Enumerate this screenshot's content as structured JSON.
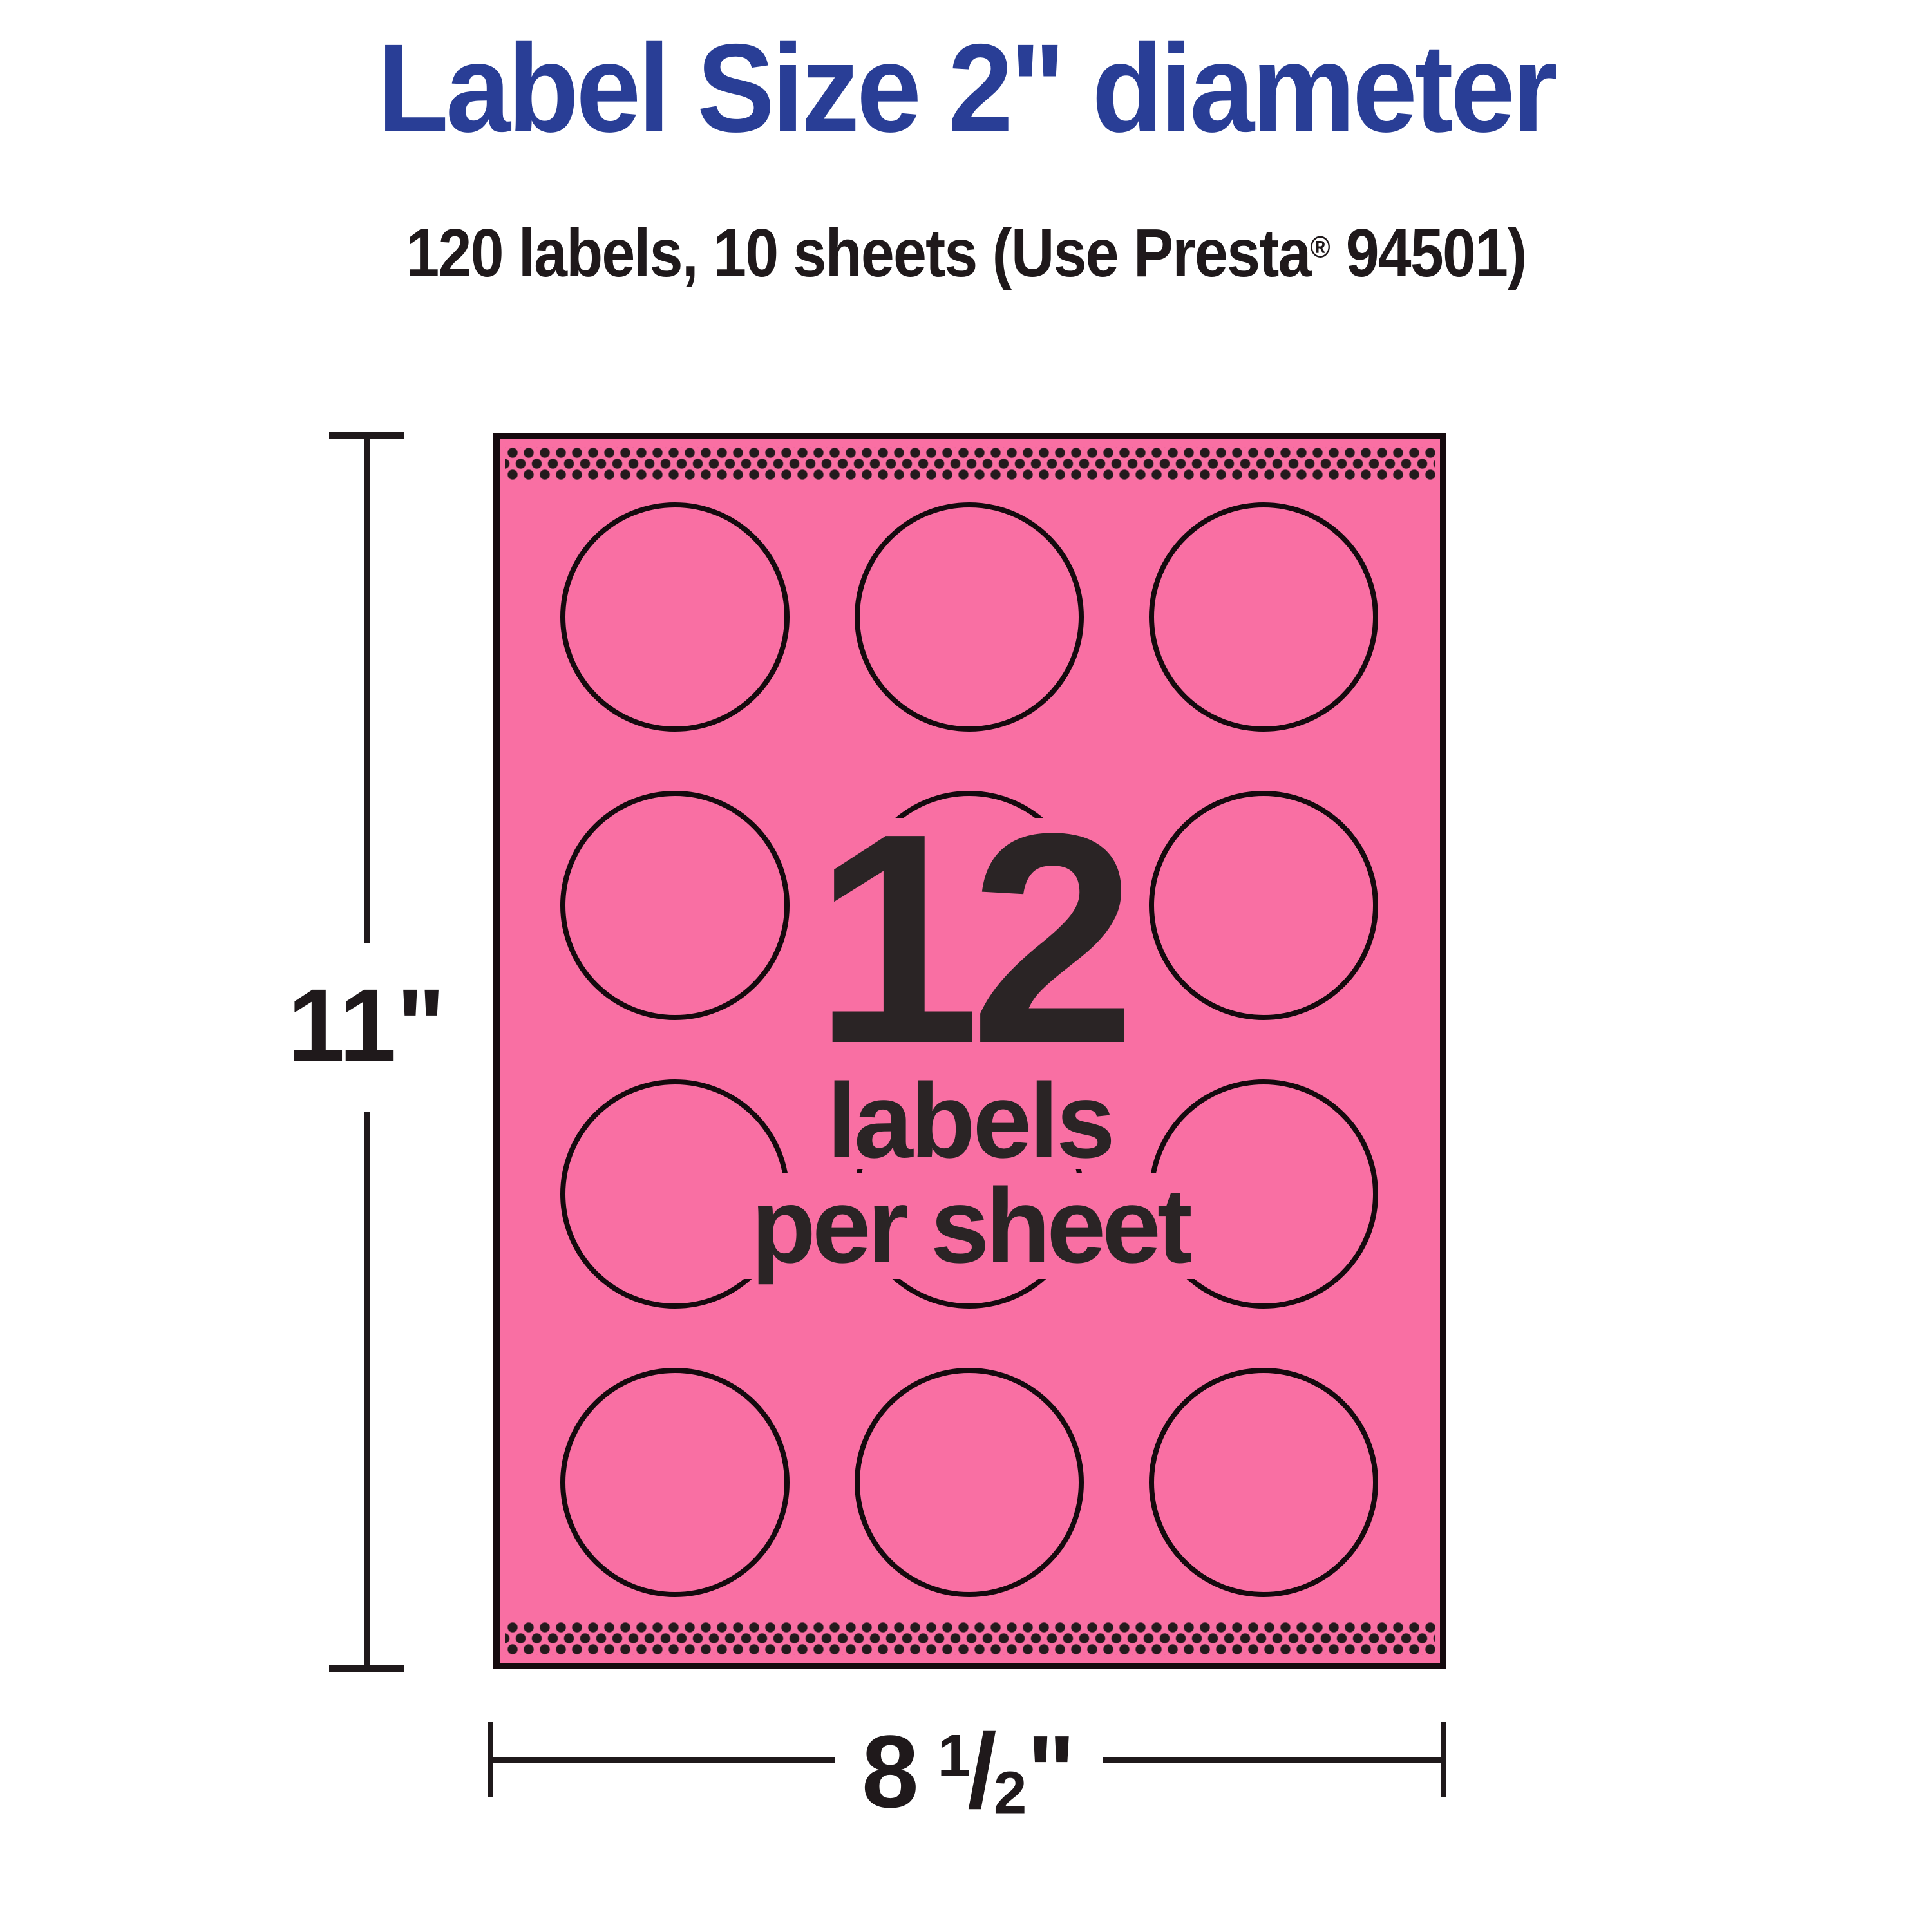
{
  "theme": {
    "sheet_pink": "#F96FA3",
    "title_blue": "#293E96",
    "ink_black": "#1F191B",
    "outline_black": "#150A0E"
  },
  "header": {
    "title": "Label Size 2\" diameter",
    "subtitle_pre": "120 labels, 10 sheets (Use Presta",
    "subtitle_reg": "®",
    "subtitle_post": " 94501)"
  },
  "sheet": {
    "count": "12",
    "caption_line1": "labels",
    "caption_line2": "per sheet",
    "grid": {
      "rows": 4,
      "cols": 3,
      "total_circles": 12
    },
    "perforation_strips": 2
  },
  "dimensions": {
    "height_label": "11\"",
    "width_whole": "8",
    "width_numerator": "1",
    "width_slash": "/",
    "width_denominator": "2",
    "width_unit": "\""
  }
}
